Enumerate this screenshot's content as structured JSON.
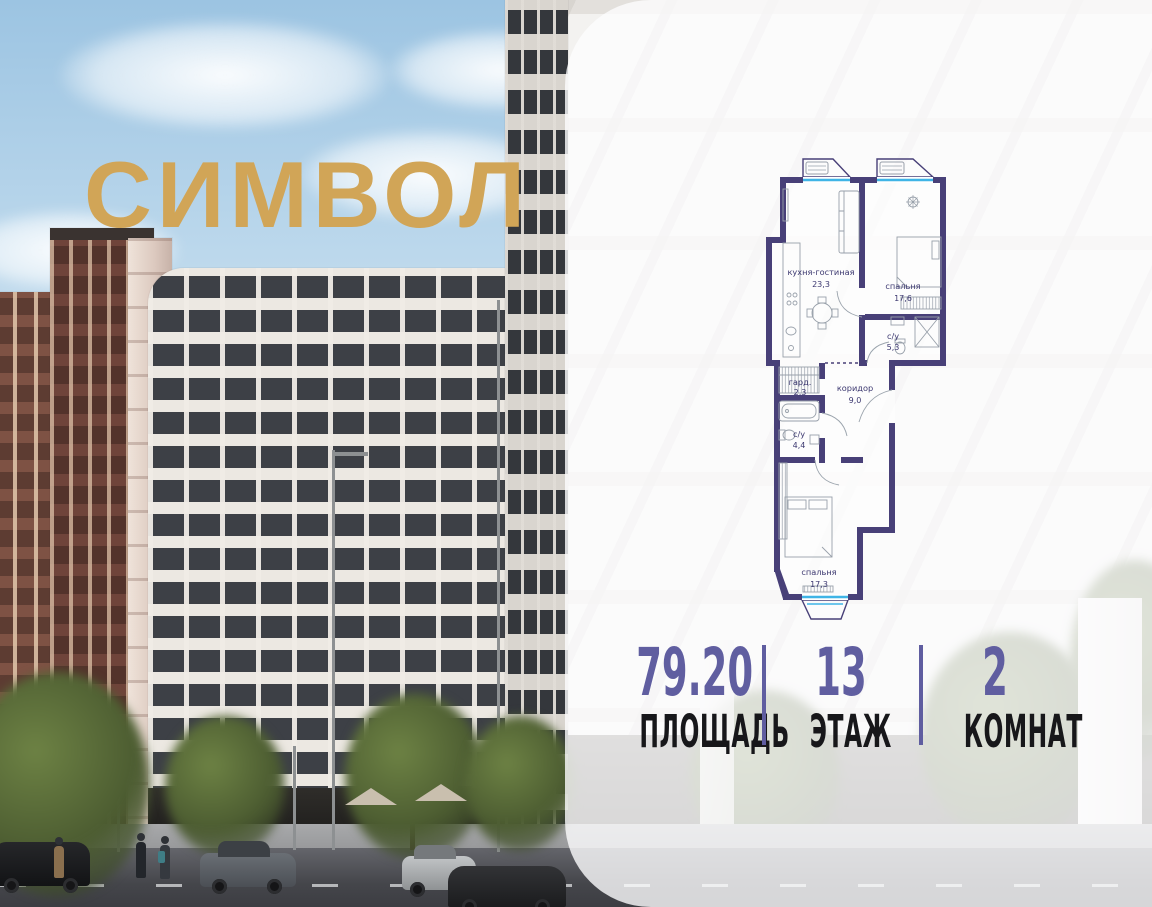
{
  "logo": {
    "text": "СИМВОЛ",
    "color": "#d1a557"
  },
  "floorplan": {
    "wall_color": "#484078",
    "window_color": "#3fb4e6",
    "label_color": "#3c3870",
    "rooms": [
      {
        "name": "кухня-гостиная",
        "area": "23,3"
      },
      {
        "name": "спальня",
        "area": "17,6"
      },
      {
        "name": "с/у",
        "area": "5,3"
      },
      {
        "name": "гард.",
        "area": "2,3"
      },
      {
        "name": "коридор",
        "area": "9,0"
      },
      {
        "name": "с/у",
        "area": "4,4"
      },
      {
        "name": "спальня",
        "area": "17,3"
      }
    ]
  },
  "stats": {
    "accent_color": "#605ea0",
    "items": [
      {
        "value": "79.20",
        "label": "ПЛОЩАДЬ"
      },
      {
        "value": "13",
        "label": "ЭТАЖ"
      },
      {
        "value": "2",
        "label": "КОМНАТ"
      }
    ]
  }
}
